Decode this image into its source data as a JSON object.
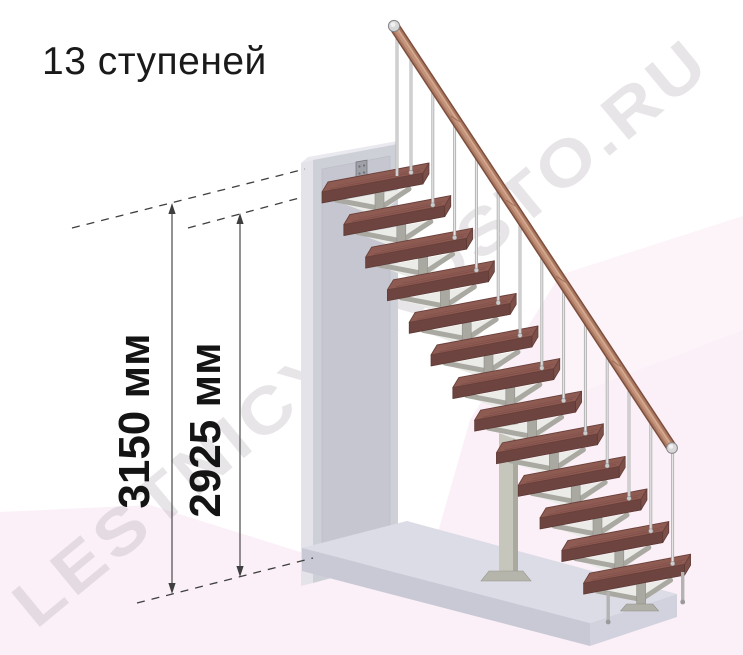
{
  "page": {
    "title": "13 ступеней"
  },
  "watermark": {
    "text": "LESTNICYPROSTO.RU"
  },
  "staircase": {
    "steps_count": 13,
    "has_handrail": true,
    "balusters_per_step": 1
  },
  "dimensions": [
    {
      "id": "total-height",
      "label": "3150 мм"
    },
    {
      "id": "height-to-top-step",
      "label": "2925 мм"
    }
  ],
  "colors": {
    "tread_top": "#8e5b53",
    "tread_front": "#6d443f",
    "tread_side": "#7c4f49",
    "tread_streak": "#774741",
    "rail_dark": "#7d4e3d",
    "rail_mid": "#aa7860",
    "rail_light": "#c2927a",
    "rail_hilite": "#d7ac91",
    "metal": "#b3b3b3",
    "metal_light": "#e8e8e8",
    "support": "#a9a9a2",
    "support_light": "#ebebe8",
    "support_edge": "#8f8f87",
    "wall_face": "#ced0d8",
    "wall_edge": "#e3e3e9",
    "wall_panel": "#c5c6cf",
    "wall_top": "#e9e9ef",
    "bracket": "#9fa1a8",
    "slab_top": "#dcdce6",
    "slab_front": "#c9c9d6",
    "slab_side": "#d2d2de",
    "column": "#c6c6bc",
    "column_side": "#a9a99e",
    "floor_pink": "#fbf0f7",
    "wall_pink_hilite": "#fdf4fa",
    "dim_line": "#3f3f3f",
    "title_text": "#1a1a1a",
    "cap_metal": "#d8d8d8"
  }
}
